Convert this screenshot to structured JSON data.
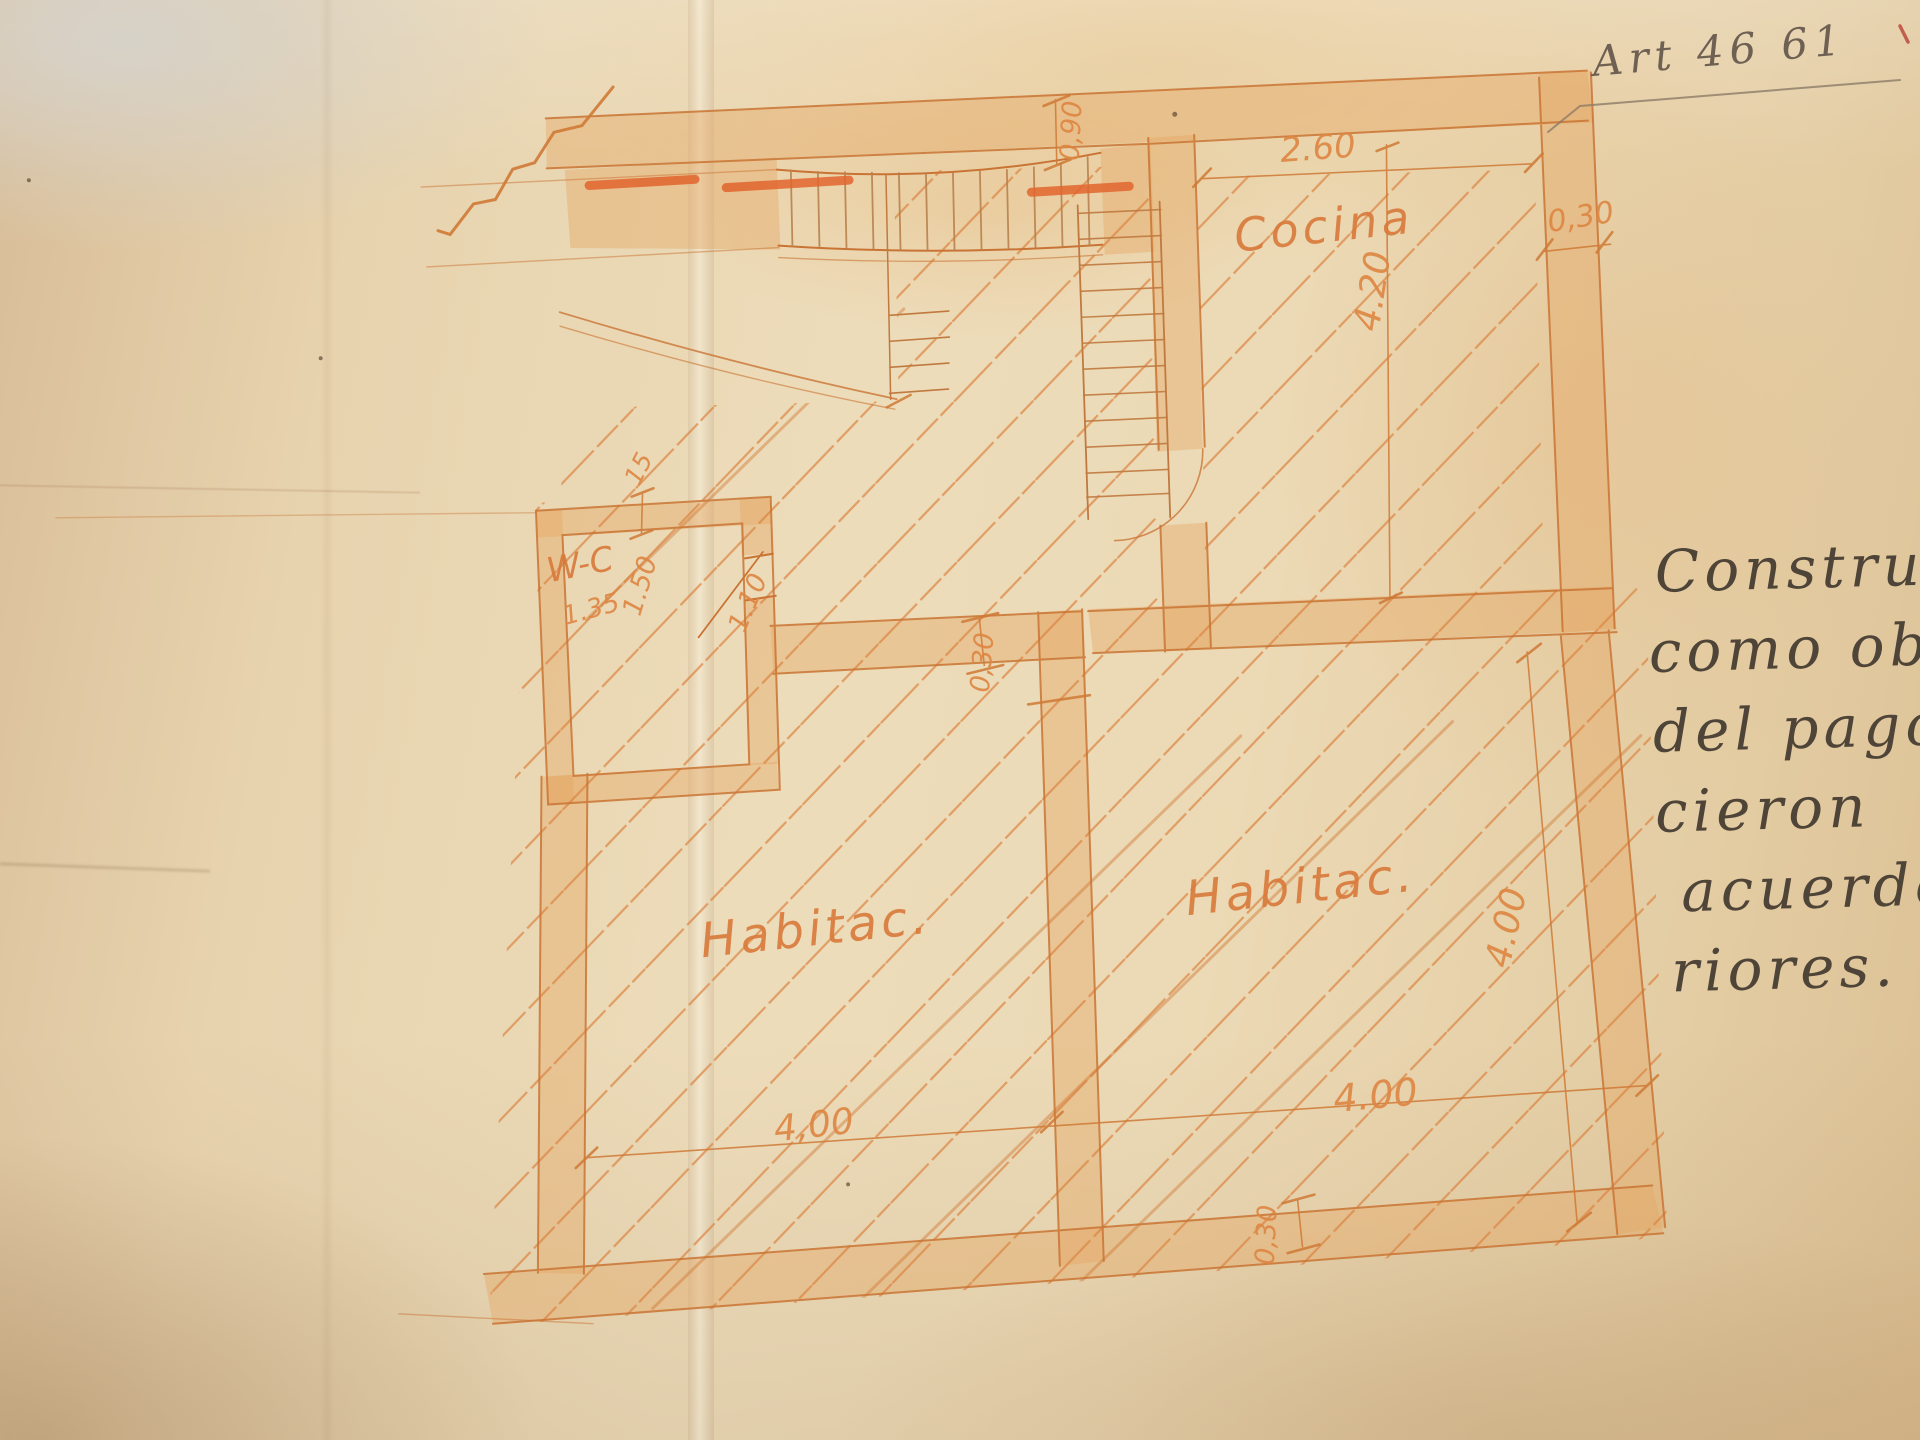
{
  "photo": {
    "description": "Photograph of a hand-drawn floor plan in orange ink on aged folded paper",
    "paper_color": "#e9d6b2",
    "ink_color": "#d9813f",
    "wash_color": "#e5a763",
    "accent_dash_color": "#e2652e",
    "pencil_color": "#4e4438"
  },
  "annotations": {
    "art_ref": "Art 46 61",
    "notes_lines": [
      "Constru",
      "como ob",
      "del pago",
      "cieron",
      "acuerdo",
      "riores."
    ]
  },
  "plan": {
    "rooms": {
      "kitchen": "Cocina",
      "wc": "W-C",
      "bedroom_left": "Habitac.",
      "bedroom_right": "Habitac."
    },
    "dims": {
      "kitchen_width": "2.60",
      "kitchen_depth": "4.20",
      "right_wall": "0,30",
      "stair_passage": "0,90",
      "wc_wall": "15",
      "wc_width": "1.35",
      "wc_depth": "1.50",
      "door_width": "1.10",
      "center_wall": "0,30",
      "bedroom_left_width": "4,00",
      "bedroom_right_width": "4.00",
      "bedroom_right_depth": "4.00",
      "bottom_wall": "0,30"
    }
  }
}
